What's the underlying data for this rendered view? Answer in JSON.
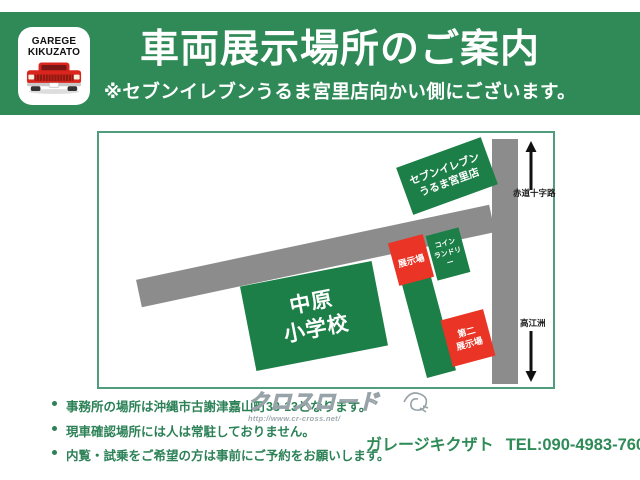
{
  "header": {
    "logo_line1": "GAREGE",
    "logo_line2": "KIKUZATO",
    "title": "車両展示場所のご案内",
    "subtitle": "※セブンイレブンうるま宮里店向かい側にございます。"
  },
  "map": {
    "seven_eleven": {
      "line1": "セブンイレブン",
      "line2": "うるま宮里店"
    },
    "school": {
      "line1": "中原",
      "line2": "小学校"
    },
    "display_lot": {
      "label": "展示場"
    },
    "coin_laundry": {
      "line1": "コイン",
      "line2": "ランドリー"
    },
    "second_display_lot": {
      "line1": "第二",
      "line2": "展示場"
    },
    "road_label_north": "赤道十字路",
    "road_label_south": "高江洲"
  },
  "notes": {
    "items": [
      "事務所の場所は沖縄市古謝津嘉山町33-13となります。",
      "現車確認場所には人は常駐しておりません。",
      "内覧・試乗をご希望の方は事前にご予約をお願いします。"
    ]
  },
  "watermark": {
    "logo_text": "クロスロード",
    "url": "http://www.cr-cross.net/"
  },
  "footer": {
    "shop_name": "ガレージキクザト",
    "phone": "TEL:090-4983-7602"
  },
  "colors": {
    "header_green": "#2f8a57",
    "block_green": "#1c7f47",
    "accent_red": "#ea3425",
    "road_gray": "#8c8c8c",
    "text_green": "#2e8b57",
    "map_border": "#4f9d7c",
    "logo_car_red": "#d9251d"
  }
}
